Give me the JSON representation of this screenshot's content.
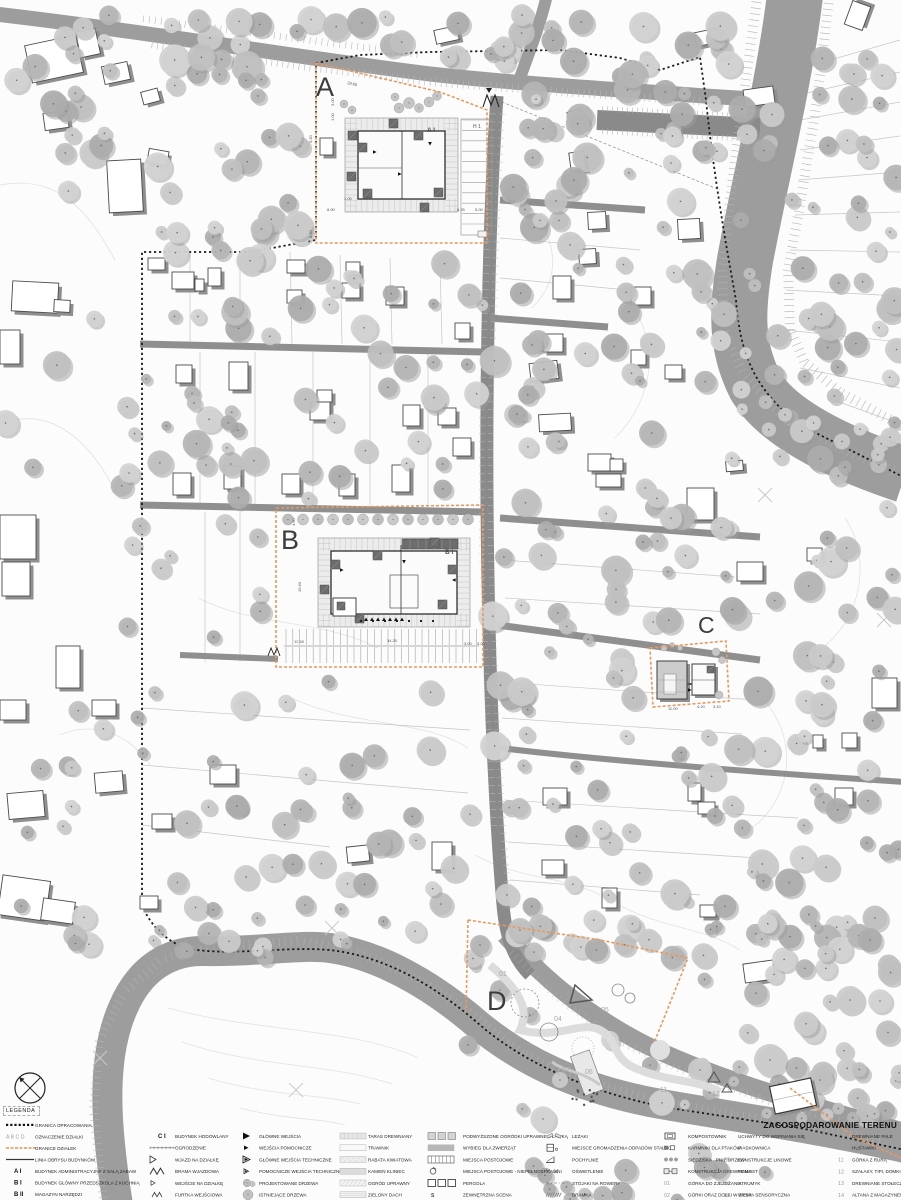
{
  "title": "ZAGOSPODAROWANIE TERENU",
  "legend": {
    "header": "LEGENDA",
    "columns": [
      {
        "items": [
          {
            "icon": "boundary-dots",
            "label": "GRANICA OPRACOWANIA"
          },
          {
            "icon": "abcd",
            "label": "OZNACZENIE DZIAŁKI"
          },
          {
            "icon": "plot-dashes",
            "label": "GRANICE DZIAŁEK"
          },
          {
            "icon": "solid-line",
            "label": "LINIA OBRYSU BUDYNKÓW"
          },
          {
            "icon": "text:A I",
            "label": "BUDYNEK ADMINISTRACYJNY Z SALĄ ZABAW"
          },
          {
            "icon": "text:B I",
            "label": "BUDYNEK GŁÓWNY PRZEDSZKOLA Z KUCHNIĄ"
          },
          {
            "icon": "text:B II",
            "label": "MAGAZYN NARZĘDZI"
          }
        ]
      },
      {
        "items": [
          {
            "icon": "text:C I",
            "label": "BUDYNEK HODOWLANY"
          },
          {
            "icon": "fence",
            "label": "OGRODZENIE"
          },
          {
            "icon": "tri-open",
            "label": "WJAZD NA DZIAŁKĘ"
          },
          {
            "icon": "gate-m",
            "label": "BRAMA WJAZDOWA"
          },
          {
            "icon": "tri-open-sm",
            "label": "WEJŚCIE NA DZIAŁKĘ"
          },
          {
            "icon": "gate-m-sm",
            "label": "FURTKA WEJŚCIOWA"
          }
        ]
      },
      {
        "items": [
          {
            "icon": "tri-filled",
            "label": "GŁÓWNE WEJŚCIA"
          },
          {
            "icon": "tri-filled-sm",
            "label": "WEJŚCIA POMOCNICZE"
          },
          {
            "icon": "tri-tech",
            "label": "GŁÓWNE WEJŚCIA TECHNICZNE"
          },
          {
            "icon": "tri-tech-sm",
            "label": "POMOCNICZE WEJŚCIA TECHNICZNE"
          },
          {
            "icon": "tree-new",
            "label": "PROJEKTOWANE DRZEWA"
          },
          {
            "icon": "tree-old",
            "label": "ISTNIEJĄCE DRZEWA"
          }
        ]
      },
      {
        "items": [
          {
            "icon": "swatch-taras",
            "label": "TARAS DREWNIANY"
          },
          {
            "icon": "swatch-trawnik",
            "label": "TRAWNIK"
          },
          {
            "icon": "swatch-rabata",
            "label": "RABATA KWIATOWA"
          },
          {
            "icon": "swatch-kamien",
            "label": "KAMIEŃ KLINIEC"
          },
          {
            "icon": "swatch-ogrod",
            "label": "OGRÓD UPRAWNY"
          },
          {
            "icon": "swatch-dach",
            "label": "ZIELONY DACH"
          }
        ]
      },
      {
        "items": [
          {
            "icon": "raised-beds",
            "label": "PODWYŻSZONE OGRÓDKI UPRAWNE Z ŁAWKĄ"
          },
          {
            "icon": "swatch-wybieg",
            "label": "WYBIEG DLA ZWIERZĄT"
          },
          {
            "icon": "stalls",
            "label": "MIEJSCA POSTOJOWE"
          },
          {
            "icon": "wheel",
            "label": "MIEJSCA POSTOJOWE - NIEPEŁNOSPRAWNI"
          },
          {
            "icon": "pergola",
            "label": "PERGOLA"
          },
          {
            "icon": "scena",
            "label": "ZEWNĘTRZNA SCENA"
          }
        ]
      },
      {
        "items": [
          {
            "icon": "lezaki",
            "label": "LEŻAKI"
          },
          {
            "icon": "waste",
            "label": "MIEJSCE GROMADZENIA ODPADÓW STAŁYCH"
          },
          {
            "icon": "ramp",
            "label": "POCHYLNIE"
          },
          {
            "icon": "lights",
            "label": "OŚWIETLENIE"
          },
          {
            "icon": "bike",
            "label": "STOJAKI NA ROWERY"
          },
          {
            "icon": "bramka",
            "label": "BRAMKA"
          }
        ]
      },
      {
        "items": [
          {
            "icon": "compost",
            "label": "KOMPOSTOWNIK"
          },
          {
            "icon": "birds",
            "label": "KARMNIKI DLA PTAKÓW"
          },
          {
            "icon": "stumps",
            "label": "SIEDZISKA - PNIE DRZEW"
          },
          {
            "icon": "wood",
            "label": "KONSTRUKCJA DREWNIANA"
          },
          {
            "icon": "num:01",
            "label": "GÓRKA DO ZJEŻDŻANIA"
          },
          {
            "icon": "num:02",
            "label": "GÓRKI ORAZ DOŁKI W ZIEMI"
          }
        ]
      },
      {
        "items": [
          {
            "icon": "",
            "label": "UCHWYTY DO WSPINANIA SIĘ"
          },
          {
            "icon": "",
            "label": "PIASKOWNICA"
          },
          {
            "icon": "num:05",
            "label": "KONSTRUKCJE LINOWE"
          },
          {
            "icon": "num:06",
            "label": "POMOST"
          },
          {
            "icon": "num:07",
            "label": "STRUMYK"
          },
          {
            "icon": "num:08",
            "label": "WYSPA SENSORYCZNA"
          }
        ]
      },
      {
        "items": [
          {
            "icon": "",
            "label": "DREWNIANE PALE"
          },
          {
            "icon": "num:10",
            "label": "HUŚTAWKI"
          },
          {
            "icon": "num:11",
            "label": "GÓRKA Z RURĄ"
          },
          {
            "icon": "num:12",
            "label": "SZAŁASY, TIPI, DOMKI"
          },
          {
            "icon": "num:13",
            "label": "DREWNIANE STOŁECZKI"
          },
          {
            "icon": "num:14",
            "label": "ALTANA Z MAGAZYNEM"
          }
        ]
      }
    ]
  },
  "map": {
    "plot_letters": [
      "A",
      "B",
      "C",
      "D"
    ],
    "building_labels": [
      "A I",
      "B I",
      "H 1"
    ],
    "annotations": [
      {
        "t": "A",
        "x": 316,
        "y": 96,
        "s": 27,
        "c": "#3c3c3c"
      },
      {
        "t": "B",
        "x": 281,
        "y": 549,
        "s": 27,
        "c": "#3c3c3c"
      },
      {
        "t": "C",
        "x": 698,
        "y": 633,
        "s": 23,
        "c": "#3c3c3c"
      },
      {
        "t": "D",
        "x": 487,
        "y": 1010,
        "s": 27,
        "c": "#3c3c3c"
      },
      {
        "t": "A I",
        "x": 427,
        "y": 132,
        "s": 6.5,
        "w": "bold"
      },
      {
        "t": "H 1",
        "x": 473,
        "y": 128,
        "s": 5
      },
      {
        "t": "B I",
        "x": 445,
        "y": 554,
        "s": 6.5,
        "w": "bold"
      },
      {
        "t": "29.65",
        "x": 347,
        "y": 84,
        "s": 4,
        "r": 13
      },
      {
        "t": "3.00",
        "x": 334,
        "y": 106,
        "s": 4,
        "r": -90
      },
      {
        "t": "1.00",
        "x": 334,
        "y": 121,
        "s": 4,
        "r": -90
      },
      {
        "t": "3.50",
        "x": 312,
        "y": 143,
        "s": 4,
        "r": -90
      },
      {
        "t": "8.50",
        "x": 312,
        "y": 238,
        "s": 4,
        "r": -90
      },
      {
        "t": "8.90",
        "x": 327,
        "y": 211,
        "s": 4
      },
      {
        "t": "1.00",
        "x": 344,
        "y": 200,
        "s": 4
      },
      {
        "t": "6.25",
        "x": 457,
        "y": 211,
        "s": 4
      },
      {
        "t": "5.00",
        "x": 475,
        "y": 211,
        "s": 4
      },
      {
        "t": "4.60",
        "x": 295,
        "y": 526,
        "s": 4,
        "r": -90
      },
      {
        "t": "3.00",
        "x": 295,
        "y": 539,
        "s": 4,
        "r": -90
      },
      {
        "t": "19.60",
        "x": 301,
        "y": 592,
        "s": 4,
        "r": -90
      },
      {
        "t": "12.50",
        "x": 294,
        "y": 643,
        "s": 4
      },
      {
        "t": "34.20",
        "x": 387,
        "y": 642,
        "s": 4
      },
      {
        "t": "3.00",
        "x": 464,
        "y": 645,
        "s": 4
      },
      {
        "t": "3.20",
        "x": 477,
        "y": 645,
        "s": 4
      },
      {
        "t": "11.00",
        "x": 668,
        "y": 710,
        "s": 4
      },
      {
        "t": "4.20",
        "x": 697,
        "y": 708,
        "s": 4
      },
      {
        "t": "3.10",
        "x": 713,
        "y": 708,
        "s": 4
      },
      {
        "t": "01",
        "x": 499,
        "y": 976,
        "s": 7,
        "c": "#a8a8a8"
      },
      {
        "t": "04",
        "x": 554,
        "y": 1021,
        "s": 7,
        "c": "#a8a8a8"
      },
      {
        "t": "05",
        "x": 601,
        "y": 1012,
        "s": 7,
        "c": "#a8a8a8"
      },
      {
        "t": "07",
        "x": 562,
        "y": 1072,
        "s": 7,
        "c": "#a8a8a8"
      },
      {
        "t": "06",
        "x": 585,
        "y": 1074,
        "s": 7,
        "c": "#a8a8a8"
      },
      {
        "t": "08",
        "x": 575,
        "y": 1099,
        "s": 7,
        "c": "#a8a8a8"
      },
      {
        "t": "11",
        "x": 660,
        "y": 1092,
        "s": 7,
        "c": "#a8a8a8"
      },
      {
        "t": "12",
        "x": 712,
        "y": 1096,
        "s": 7,
        "c": "#a8a8a8"
      },
      {
        "t": "14",
        "x": 754,
        "y": 1099,
        "s": 7,
        "c": "#a8a8a8"
      }
    ],
    "colors": {
      "road": "#9d9d9d",
      "road_dark": "#8a8a8a",
      "plot_boundary_orange": "#e59a5f",
      "site_boundary_black": "#1a1a1a",
      "tree_gray": "#bdbdbd",
      "building_shadow": "#8f8f8f",
      "deck_gray": "#ececec"
    }
  }
}
